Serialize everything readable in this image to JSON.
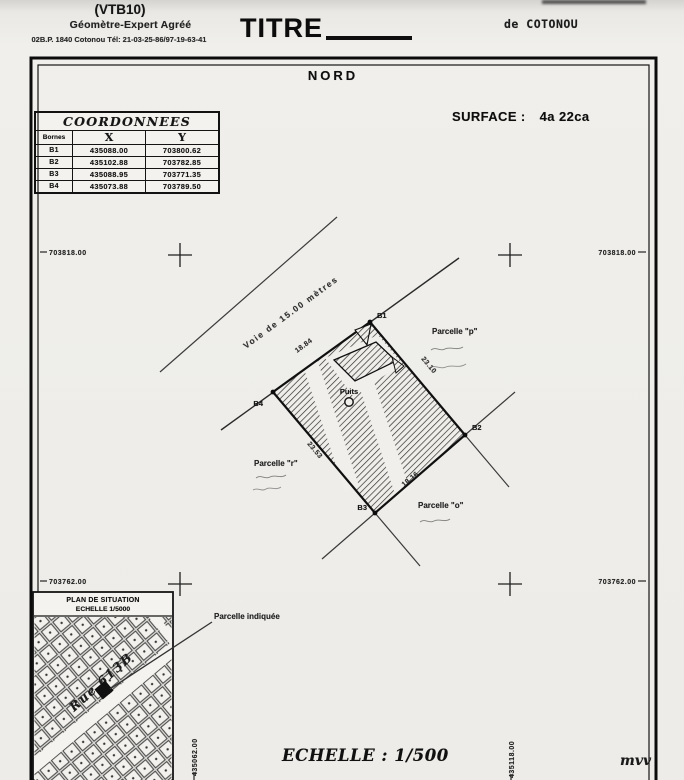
{
  "header": {
    "ref_code": "(VTB10)",
    "profession": "Géomètre-Expert Agréé",
    "address_line": "02B.P. 1840 Cotonou Tél: 21-03-25-86/97-19-63-41",
    "title_word": "TITRE",
    "city_line": "de COTONOU"
  },
  "frame": {
    "north_label": "NORD",
    "surface_label": "SURFACE :",
    "surface_value": "4a 22ca",
    "main_scale_label": "ECHELLE : 1/500",
    "signature": "mvv"
  },
  "coordinates_table": {
    "title": "COORDONNEES",
    "columns": [
      "Bornes",
      "X",
      "Y"
    ],
    "rows": [
      {
        "borne": "B1",
        "x": "435088.00",
        "y": "703800.62"
      },
      {
        "borne": "B2",
        "x": "435102.88",
        "y": "703782.85"
      },
      {
        "borne": "B3",
        "x": "435088.95",
        "y": "703771.35"
      },
      {
        "borne": "B4",
        "x": "435073.88",
        "y": "703789.50"
      }
    ]
  },
  "grid": {
    "north_top": "703818.00",
    "north_bottom": "703762.00",
    "east_left": "435062.00",
    "east_right": "435118.00"
  },
  "drawing": {
    "road_label": "Voie de 15.00 mètres",
    "well_label": "Puits",
    "borne_labels": {
      "b1": "B1",
      "b2": "B2",
      "b3": "B3",
      "b4": "B4"
    },
    "measurements": {
      "b4_b1": "18.84",
      "b1_b2": "23.10",
      "b4_b3": "23.53",
      "b3_b2": "18.16"
    },
    "parcel_p_label": "Parcelle \"p\"",
    "parcel_r_label": "Parcelle \"r\"",
    "parcel_o_label": "Parcelle \"o\"",
    "indicated_parcel_label": "Parcelle indiquée"
  },
  "situation_plan": {
    "title": "PLAN DE SITUATION",
    "scale": "ECHELLE 1/5000",
    "street_label": "Rue 613B"
  }
}
